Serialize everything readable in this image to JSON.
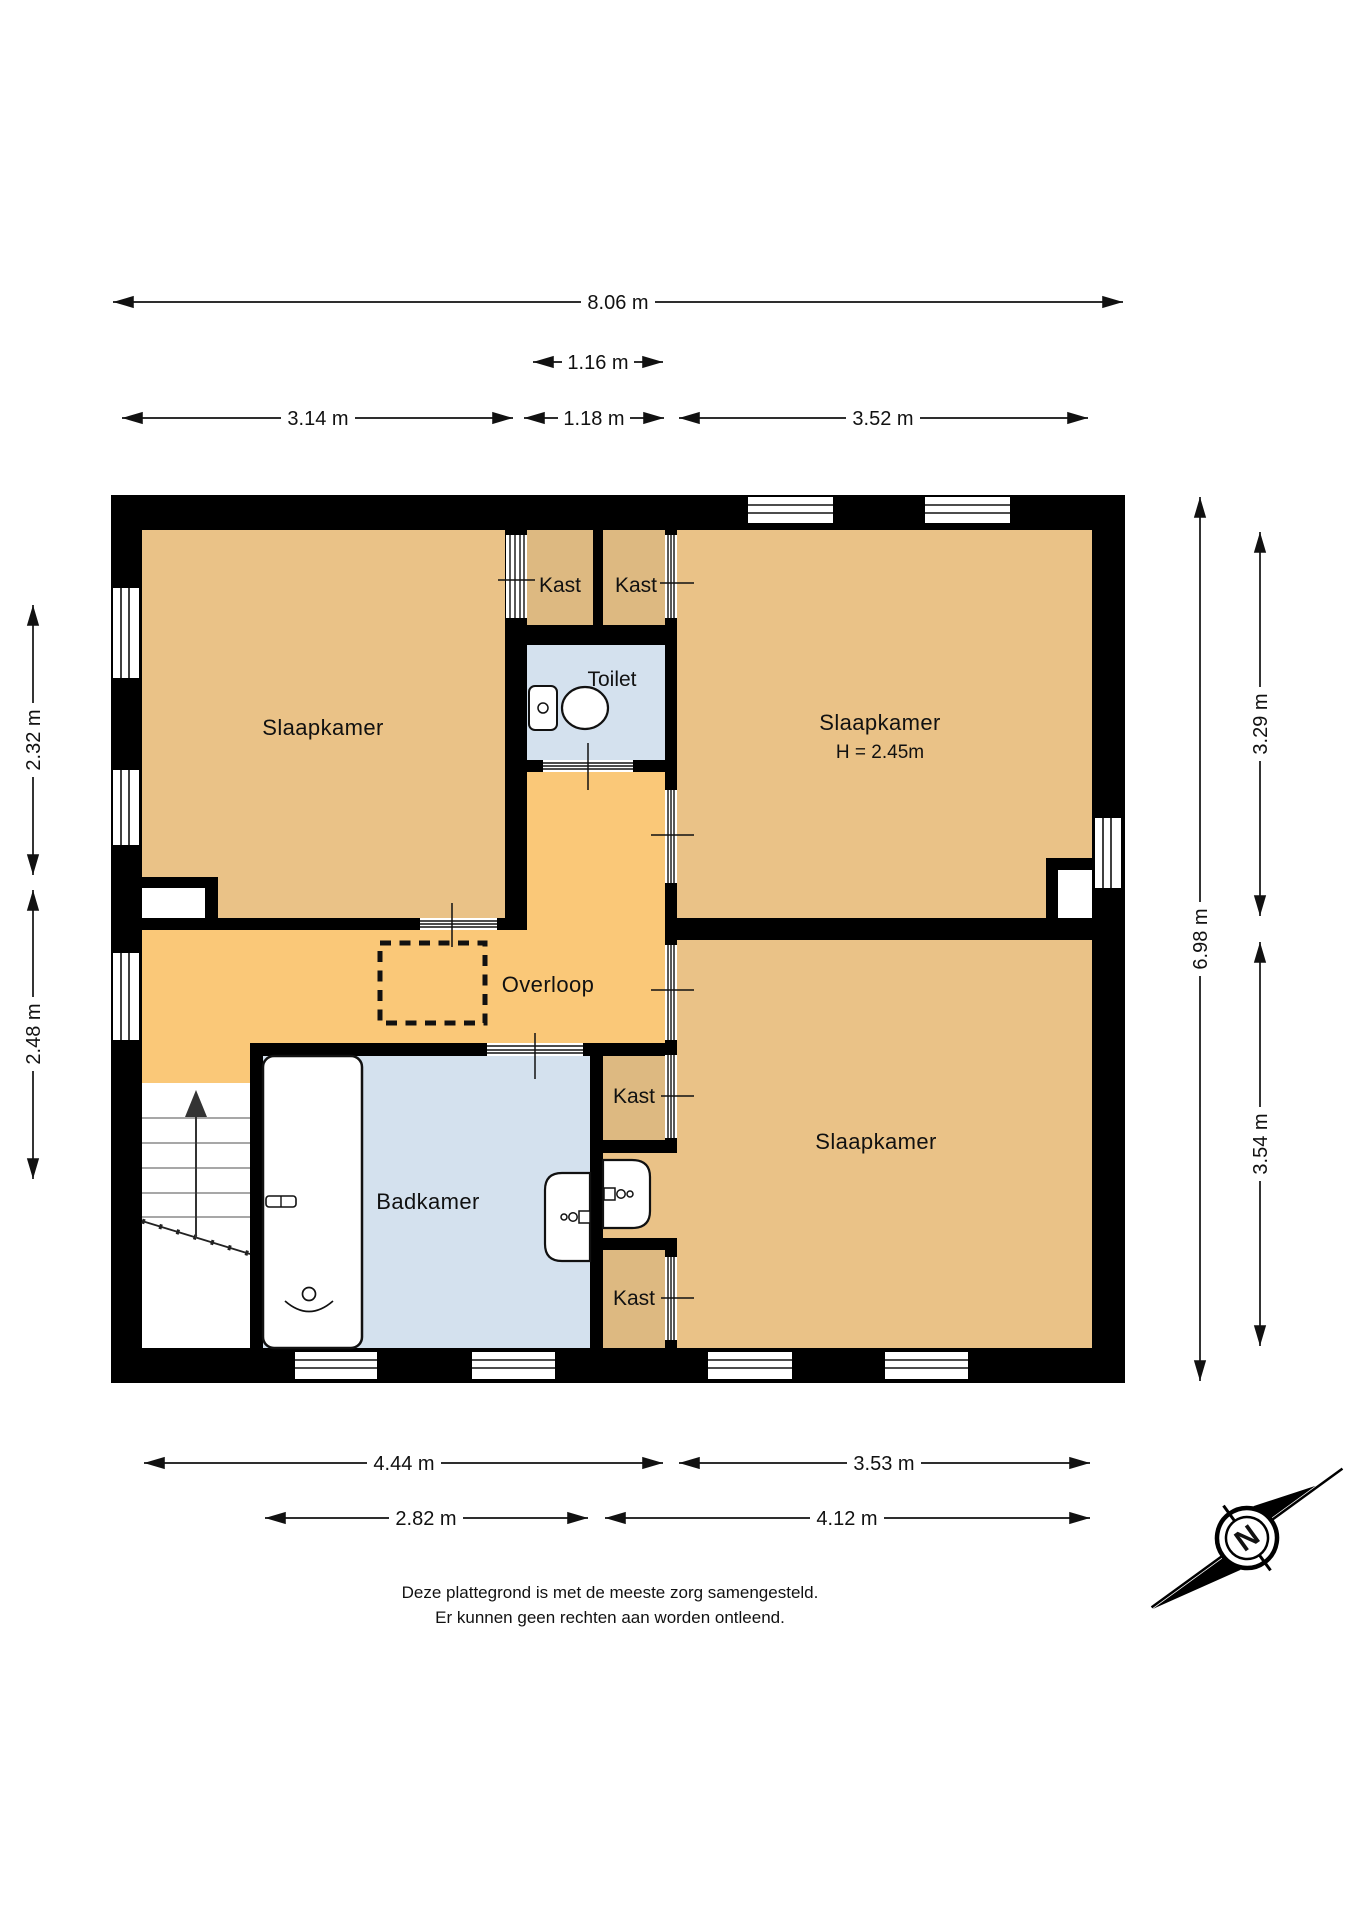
{
  "plan": {
    "rooms": [
      {
        "id": "slaapkamer-left",
        "label": "Slaapkamer"
      },
      {
        "id": "slaapkamer-right-top",
        "label": "Slaapkamer",
        "height_note": "H = 2.45m"
      },
      {
        "id": "slaapkamer-right-bottom",
        "label": "Slaapkamer"
      },
      {
        "id": "overloop",
        "label": "Overloop"
      },
      {
        "id": "badkamer",
        "label": "Badkamer"
      },
      {
        "id": "toilet",
        "label": "Toilet"
      },
      {
        "id": "kast-top-left",
        "label": "Kast"
      },
      {
        "id": "kast-top-right",
        "label": "Kast"
      },
      {
        "id": "kast-middle",
        "label": "Kast"
      },
      {
        "id": "kast-bottom",
        "label": "Kast"
      }
    ]
  },
  "dimensions": {
    "top": [
      {
        "label": "8.06 m"
      },
      {
        "label": "1.16 m"
      },
      {
        "label": "3.14 m"
      },
      {
        "label": "1.18 m"
      },
      {
        "label": "3.52 m"
      }
    ],
    "left": [
      {
        "label": "2.32 m"
      },
      {
        "label": "2.48 m"
      }
    ],
    "right": [
      {
        "label": "6.98 m"
      },
      {
        "label": "3.29 m"
      },
      {
        "label": "3.54 m"
      }
    ],
    "bottom": [
      {
        "label": "4.44 m"
      },
      {
        "label": "3.53 m"
      },
      {
        "label": "2.82 m"
      },
      {
        "label": "4.12 m"
      }
    ]
  },
  "compass": {
    "label": "N"
  },
  "disclaimer": {
    "line1": "Deze plattegrond is met de meeste zorg samengesteld.",
    "line2": "Er kunnen geen rechten aan worden ontleend."
  },
  "colors": {
    "bedroom": "#EAC287",
    "hall": "#FAC878",
    "closet": "#DDB981",
    "wet_room": "#D4E1EE",
    "wall": "#000000",
    "white": "#ffffff"
  }
}
